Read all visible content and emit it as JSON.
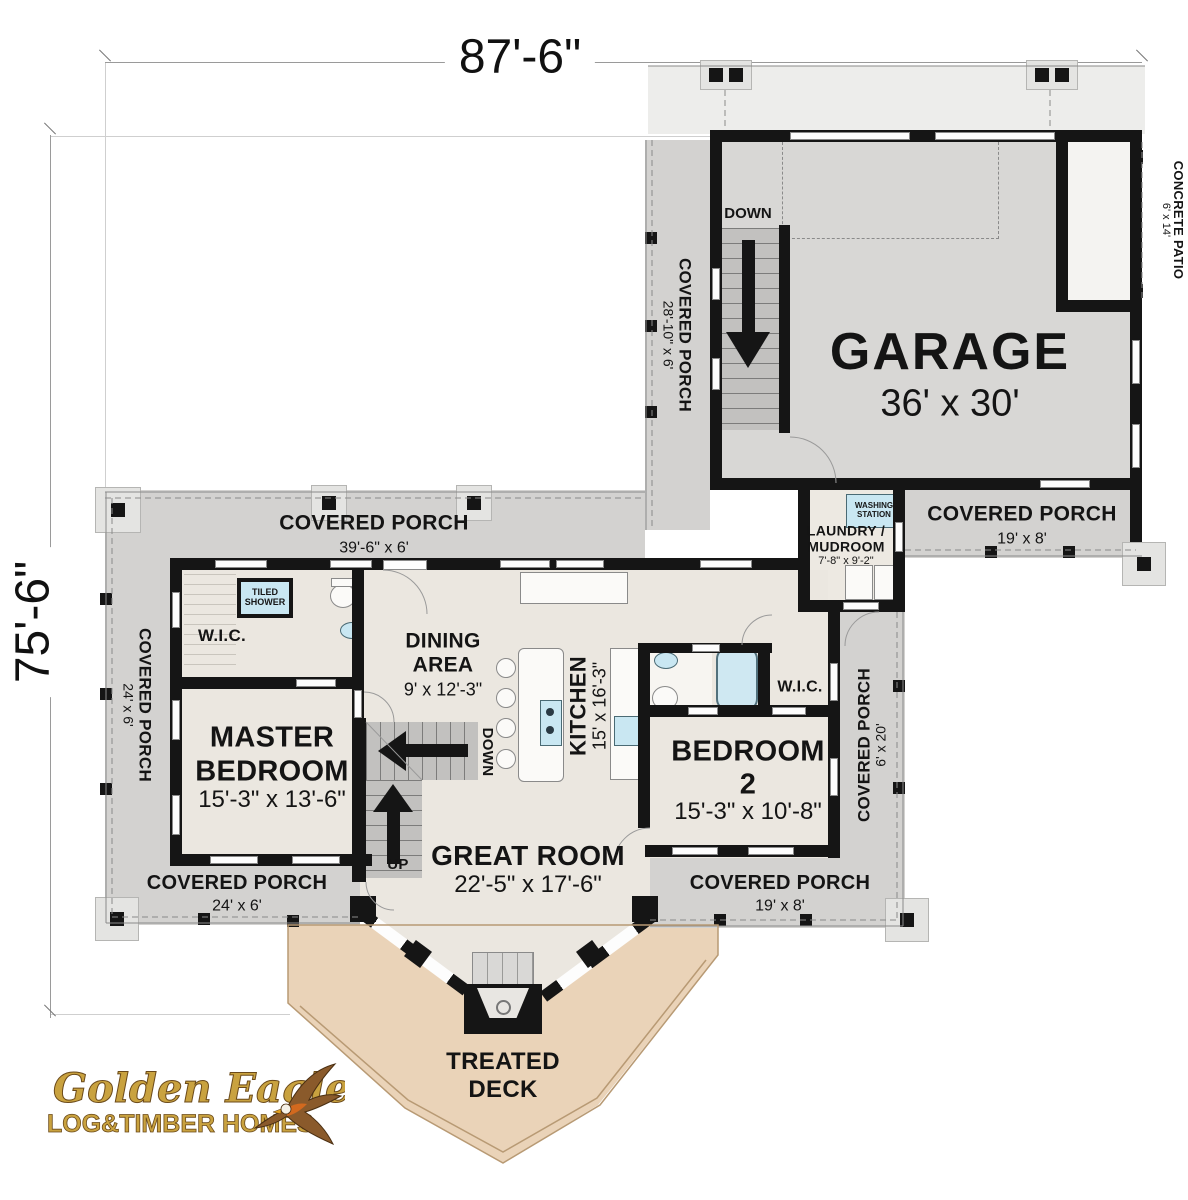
{
  "dimensions": {
    "width": "87'-6\"",
    "height": "75'-6\""
  },
  "rooms": {
    "garage": {
      "name": "GARAGE",
      "dims": "36' x 30'"
    },
    "master_bedroom": {
      "line1": "MASTER",
      "line2": "BEDROOM",
      "dims": "15'-3\" x 13'-6\""
    },
    "bedroom2": {
      "line1": "BEDROOM",
      "line2": "2",
      "dims": "15'-3\" x 10'-8\""
    },
    "great_room": {
      "name": "GREAT ROOM",
      "dims": "22'-5\" x 17'-6\""
    },
    "dining_area": {
      "line1": "DINING",
      "line2": "AREA",
      "dims": "9' x 12'-3\""
    },
    "kitchen": {
      "name": "KITCHEN",
      "dims": "15' x 16'-3\""
    },
    "laundry_mudroom": {
      "line1": "LAUNDRY /",
      "line2": "MUDROOM",
      "dims": "7'-8\" x 9'-2\""
    },
    "wic_master": {
      "name": "W.I.C."
    },
    "wic_bedroom2": {
      "name": "W.I.C."
    },
    "tiled_shower": {
      "line1": "TILED",
      "line2": "SHOWER"
    },
    "washing_station": {
      "line1": "WASHING",
      "line2": "STATION"
    }
  },
  "porches": {
    "top": {
      "name": "COVERED PORCH",
      "dims": "39'-6\" x 6'"
    },
    "left": {
      "name": "COVERED PORCH",
      "dims": "24' x 6'"
    },
    "garage_side": {
      "name": "COVERED PORCH",
      "dims": "28'-10\" x 6'"
    },
    "garage_front": {
      "name": "COVERED PORCH",
      "dims": "19' x 8'"
    },
    "bottom_left": {
      "name": "COVERED PORCH",
      "dims": "24' x 6'"
    },
    "bottom_right": {
      "name": "COVERED PORCH",
      "dims": "19' x 8'"
    },
    "right": {
      "name": "COVERED PORCH",
      "dims": "6' x 20'"
    },
    "patio": {
      "line1": "COVERED",
      "line2": "CONCRETE PATIO",
      "dims": "6' x 14'"
    }
  },
  "deck": {
    "line1": "TREATED",
    "line2": "DECK"
  },
  "stairs": {
    "garage_down": "DOWN",
    "center_down": "DOWN",
    "center_up": "UP"
  },
  "logo": {
    "name": "Golden Eagle",
    "tagline": "LOG&TIMBER HOMES"
  },
  "colors": {
    "wall": "#151515",
    "porch": "#d3d2d0",
    "garage_floor": "#d8d7d5",
    "interior": "#ebe7e0",
    "deck": "#ead3b8",
    "driveway": "#ededeb",
    "fixture_blue": "#c9e7f2",
    "logo_gold": "#c9a23f"
  }
}
